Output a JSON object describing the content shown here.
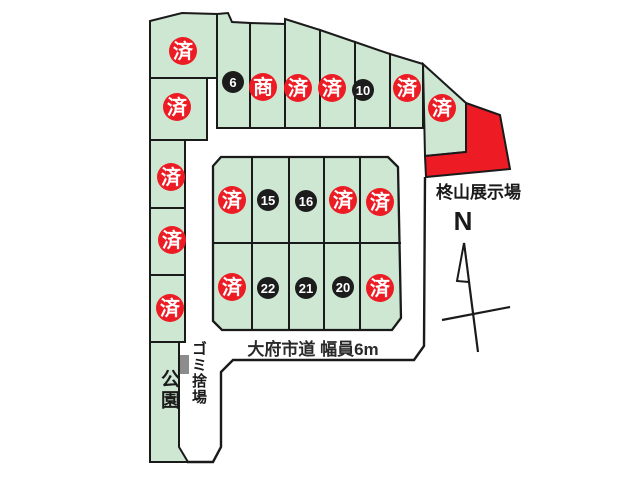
{
  "map_type": "residential-lot-plan",
  "labels": {
    "exhibition_site": "柊山展示場",
    "road": "大府市道 幅員6m",
    "park": "公園",
    "garbage_station": "ゴミ捨場",
    "north": "N"
  },
  "marker_legend": {
    "sold_label": "済",
    "commercial_label": "商"
  },
  "available_lot_numbers": [
    "6",
    "10",
    "15",
    "16",
    "20",
    "21",
    "22"
  ],
  "lot_markers": [
    {
      "label": "済",
      "status": "sold"
    },
    {
      "label": "6",
      "status": "available"
    },
    {
      "label": "商",
      "status": "commercial"
    },
    {
      "label": "済",
      "status": "sold"
    },
    {
      "label": "済",
      "status": "sold"
    },
    {
      "label": "10",
      "status": "available"
    },
    {
      "label": "済",
      "status": "sold"
    },
    {
      "label": "済",
      "status": "sold"
    },
    {
      "label": "済",
      "status": "sold"
    },
    {
      "label": "済",
      "status": "sold"
    },
    {
      "label": "済",
      "status": "sold"
    },
    {
      "label": "15",
      "status": "available"
    },
    {
      "label": "16",
      "status": "available"
    },
    {
      "label": "済",
      "status": "sold"
    },
    {
      "label": "済",
      "status": "sold"
    },
    {
      "label": "済",
      "status": "sold"
    },
    {
      "label": "済",
      "status": "sold"
    },
    {
      "label": "22",
      "status": "available"
    },
    {
      "label": "21",
      "status": "available"
    },
    {
      "label": "20",
      "status": "available"
    },
    {
      "label": "済",
      "status": "sold"
    },
    {
      "label": "済",
      "status": "sold"
    }
  ],
  "colors": {
    "lot_green": "#cde7d2",
    "sold_red": "#ed1c24",
    "available_black": "#1c1c1c",
    "exhibition_red": "#ed1c24",
    "outline_black": "#1a1a1a",
    "garbage_gray": "#8c8c8c"
  }
}
